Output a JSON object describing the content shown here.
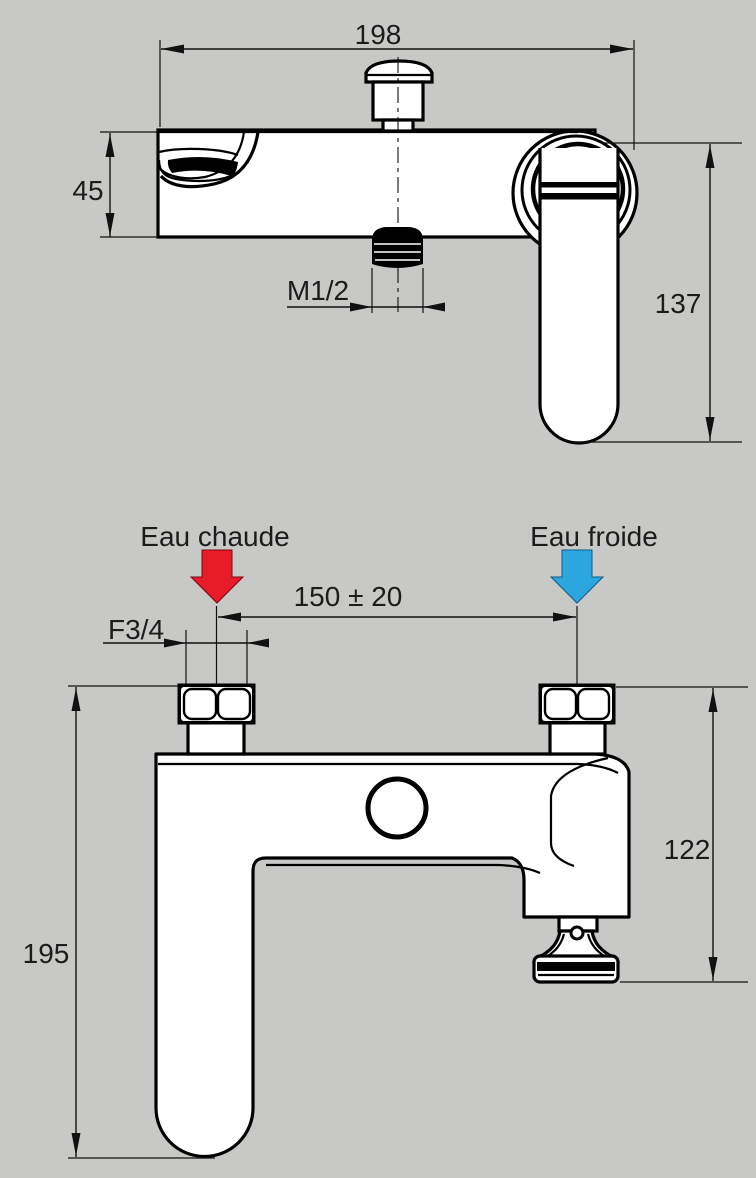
{
  "page": {
    "background": "#C8C8C6"
  },
  "colors": {
    "line": "#000000",
    "hot_arrow": "#E81B28",
    "cold_arrow": "#2BA6DF"
  },
  "top_view": {
    "width_dim": "198",
    "height_dim": "45",
    "handle_length_dim": "137",
    "outlet_thread_dim": "M1/2"
  },
  "bottom_view": {
    "hot_label": "Eau chaude",
    "cold_label": "Eau froide",
    "inlet_spacing_dim": "150 ± 20",
    "inlet_thread_dim": "F3/4",
    "total_height_dim": "195",
    "right_height_dim": "122"
  }
}
